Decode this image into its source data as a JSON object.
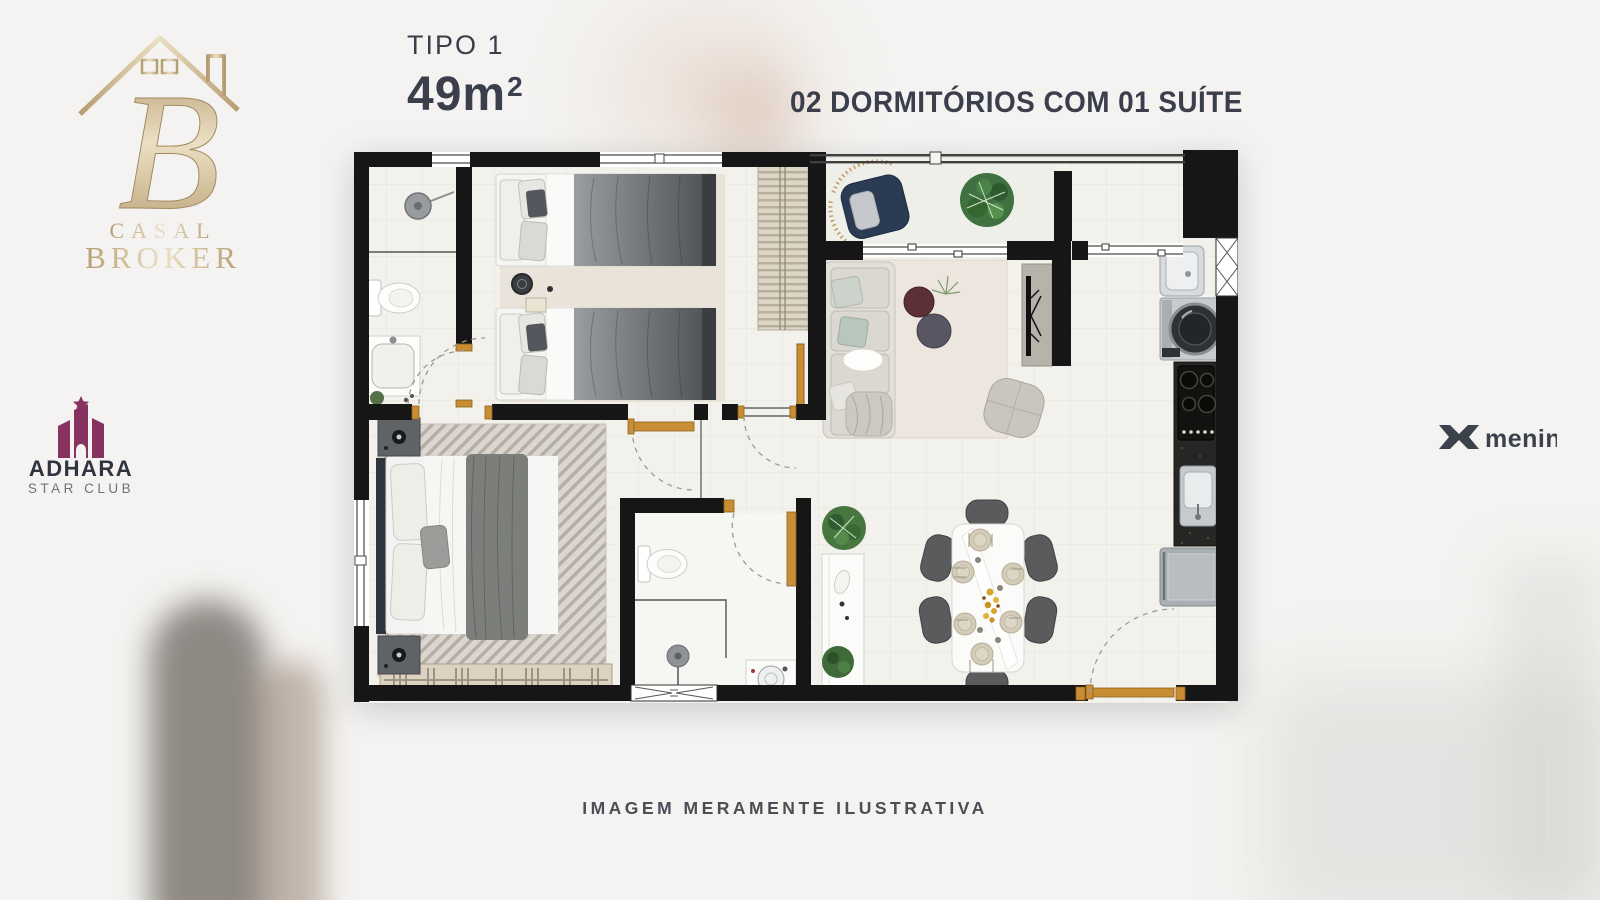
{
  "colors": {
    "background": "#f4f3f1",
    "headline_text": "#3a3f4b",
    "footer_text": "#494e57",
    "gold": "#a98a54",
    "gold_light": "#e9dcba",
    "adhara_accent": "#87325f",
    "adhara_text": "#2f3440",
    "adhara_sub": "#6d7278",
    "menin": "#3c424b",
    "wall": "#161616",
    "door": "#c98e33",
    "floor": "#f2f1ec",
    "balcony_floor": "#edefe8"
  },
  "header": {
    "type_label": "TIPO 1",
    "area_value": "49m",
    "area_sup": "2",
    "features_label": "02 DORMITÓRIOS COM 01 SUÍTE"
  },
  "logos": {
    "casal_broker": {
      "monogram": "B",
      "line1": "CASAL",
      "line2": "BROKER"
    },
    "adhara": {
      "name": "ADHARA",
      "subtitle": "STAR CLUB"
    },
    "menin": {
      "name": "menin"
    }
  },
  "footer": {
    "disclaimer": "IMAGEM MERAMENTE ILUSTRATIVA"
  }
}
